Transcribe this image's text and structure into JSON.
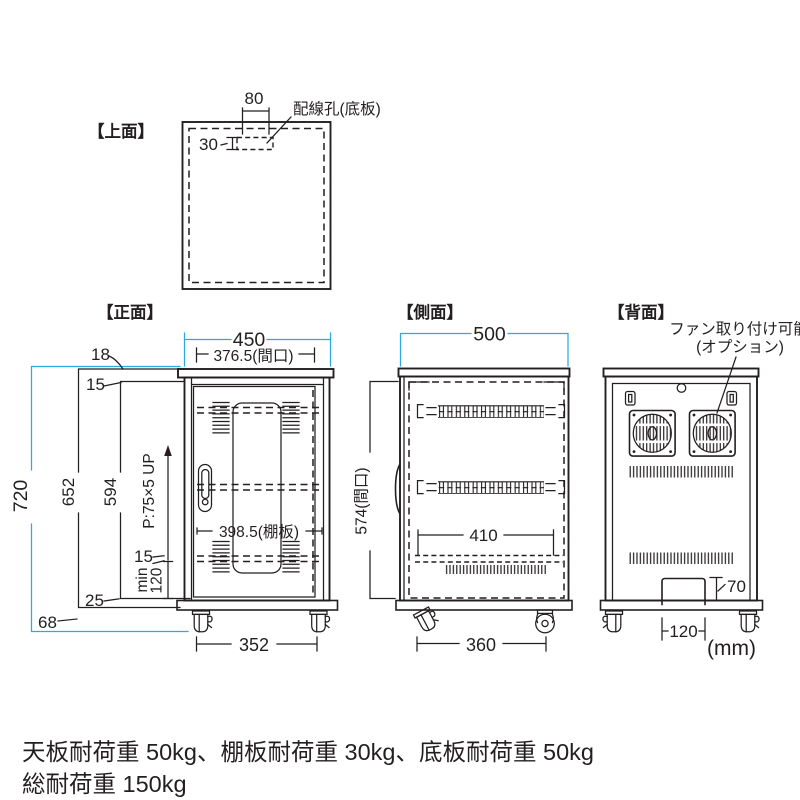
{
  "colors": {
    "line": "#231f20",
    "accent": "#29abe2"
  },
  "units_label": "(mm)",
  "views": {
    "top": {
      "title": "【上面】",
      "wiring_hole_label": "配線孔(底板)",
      "dims": {
        "hole_width": "80",
        "hole_depth": "30"
      }
    },
    "front": {
      "title": "【正面】",
      "dims": {
        "overall_width": "450",
        "opening_width": "376.5(間口)",
        "top_panel": "18",
        "top_clearance": "15",
        "overall_height": "720",
        "body_height": "652",
        "interior_height": "594",
        "shelf_pitch": "P:75×5 UP",
        "shelf_width": "398.5(棚板)",
        "shelf_clearance": "15",
        "min_label": "min",
        "min_height": "120",
        "bottom_clearance": "25",
        "caster_height": "68",
        "caster_span": "352"
      }
    },
    "side": {
      "title": "【側面】",
      "dims": {
        "overall_depth": "500",
        "opening_height": "574(間口)",
        "shelf_depth": "410",
        "caster_span": "360"
      }
    },
    "back": {
      "title": "【背面】",
      "fan_note_line1": "ファン取り付け可能",
      "fan_note_line2": "(オプション)",
      "dims": {
        "cutout_height": "70",
        "cutout_width": "120"
      }
    }
  },
  "footer": {
    "load_note": "天板耐荷重 50kg、棚板耐荷重 30kg、底板耐荷重 50kg",
    "total_load_note": "総耐荷重 150kg"
  }
}
